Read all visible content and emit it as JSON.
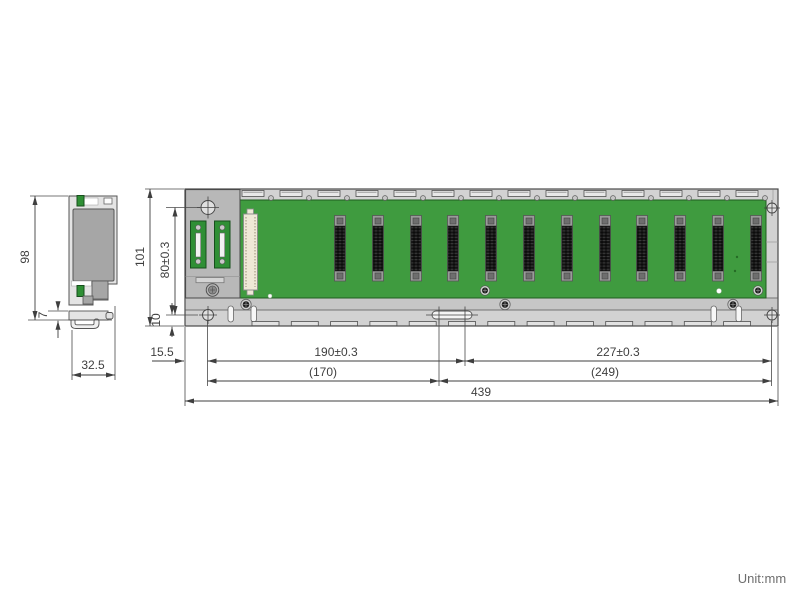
{
  "drawing": {
    "unit_note": "Unit:mm",
    "side_view": {
      "dim_height": "98",
      "dim_hook": "7",
      "dim_width": "32.5"
    },
    "front_view": {
      "dim_height": "101",
      "dim_hole_span_v": "80±0.3",
      "dim_hole_offset_v": "10",
      "dim_edge_to_hole": "15.5",
      "dim_hole_span_left": "190±0.3",
      "dim_hole_span_right": "227±0.3",
      "dim_ref_left": "(170)",
      "dim_ref_right": "(249)",
      "dim_total_width": "439",
      "io_slot_count": 12
    },
    "colors": {
      "pcb_green": "#3f9b3f",
      "connector_green": "#2f8f35",
      "frame_gray": "#d2d2d2",
      "panel_gray": "#b8b8b8",
      "body_gray": "#a6a6a6",
      "line": "#3f3f3f"
    }
  }
}
